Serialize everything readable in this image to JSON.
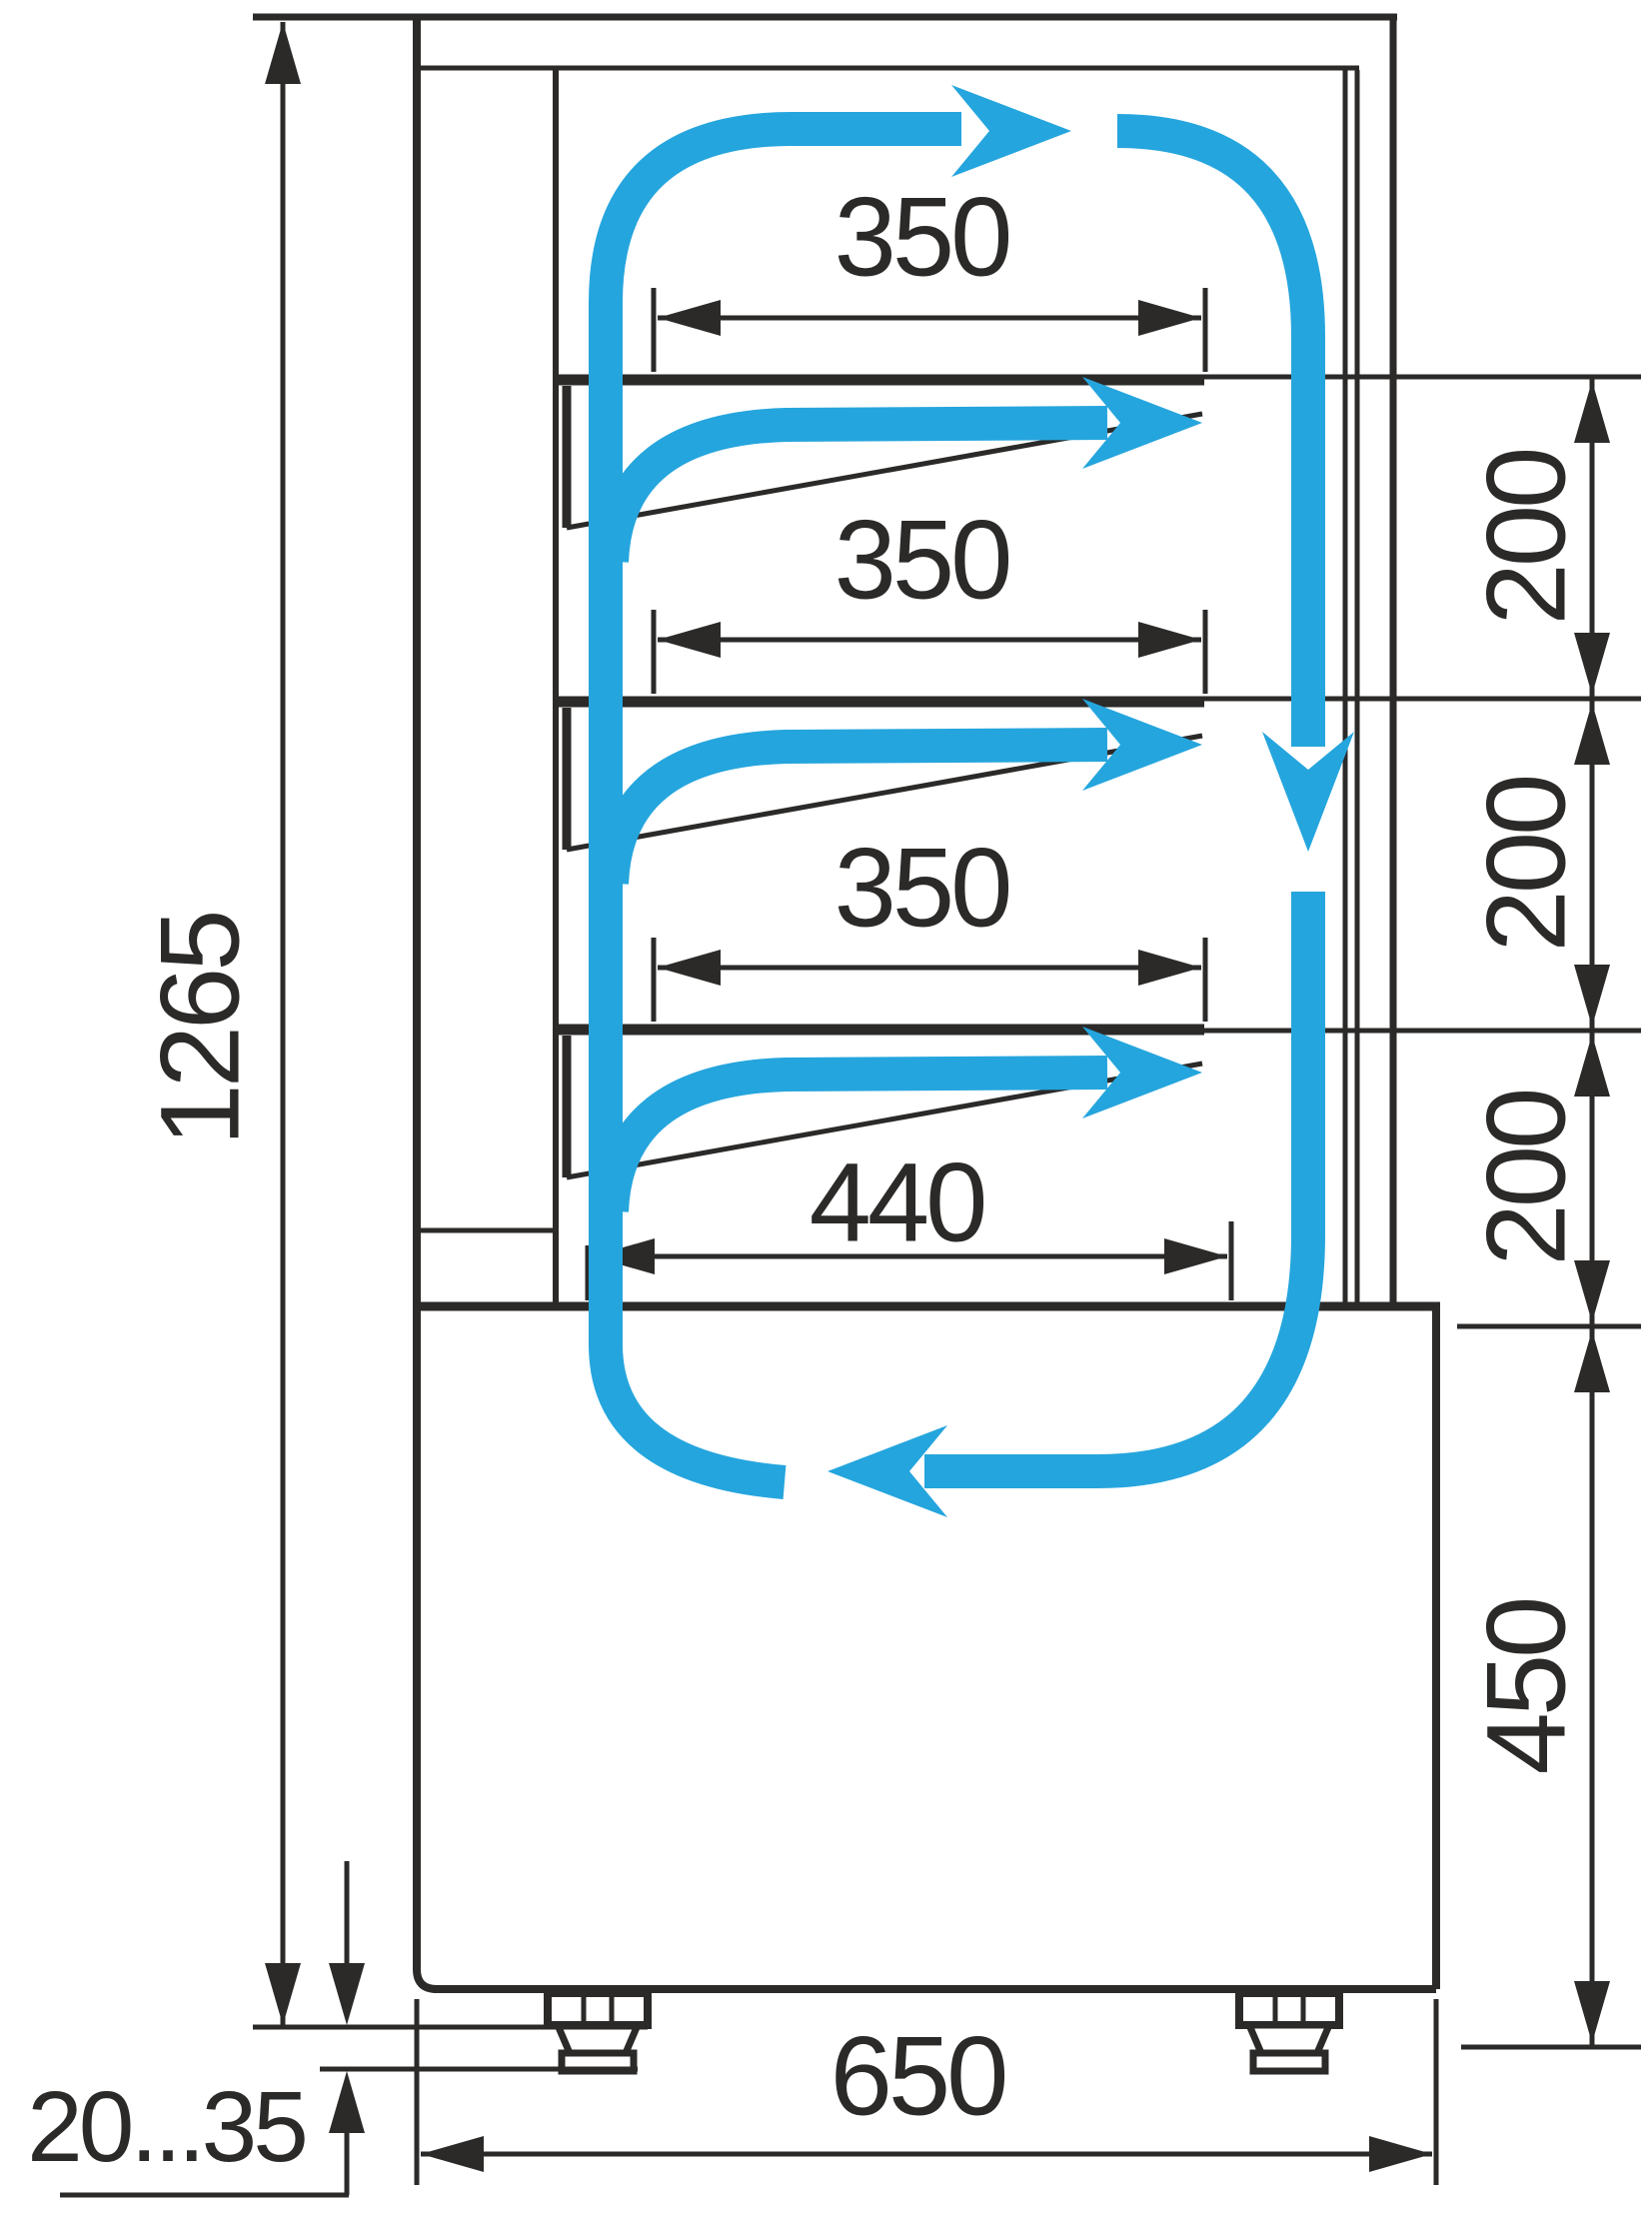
{
  "diagram": {
    "type": "technical-dimension-drawing",
    "subject": "Refrigerated confectionery display case - side section with shelf dimensions and air circulation arrows",
    "line_color": "#2b2a29",
    "airflow_color": "#25a5dd",
    "background": "#ffffff",
    "labels": {
      "total_height": "1265",
      "shelf_depth_top": "350",
      "shelf_depth_middle": "350",
      "shelf_depth_lower": "350",
      "deck_depth": "440",
      "shelf_gap_top": "200",
      "shelf_gap_middle": "200",
      "shelf_gap_lower": "200",
      "base_height": "450",
      "overall_depth": "650",
      "leg_adjust_range": "20...35"
    }
  }
}
